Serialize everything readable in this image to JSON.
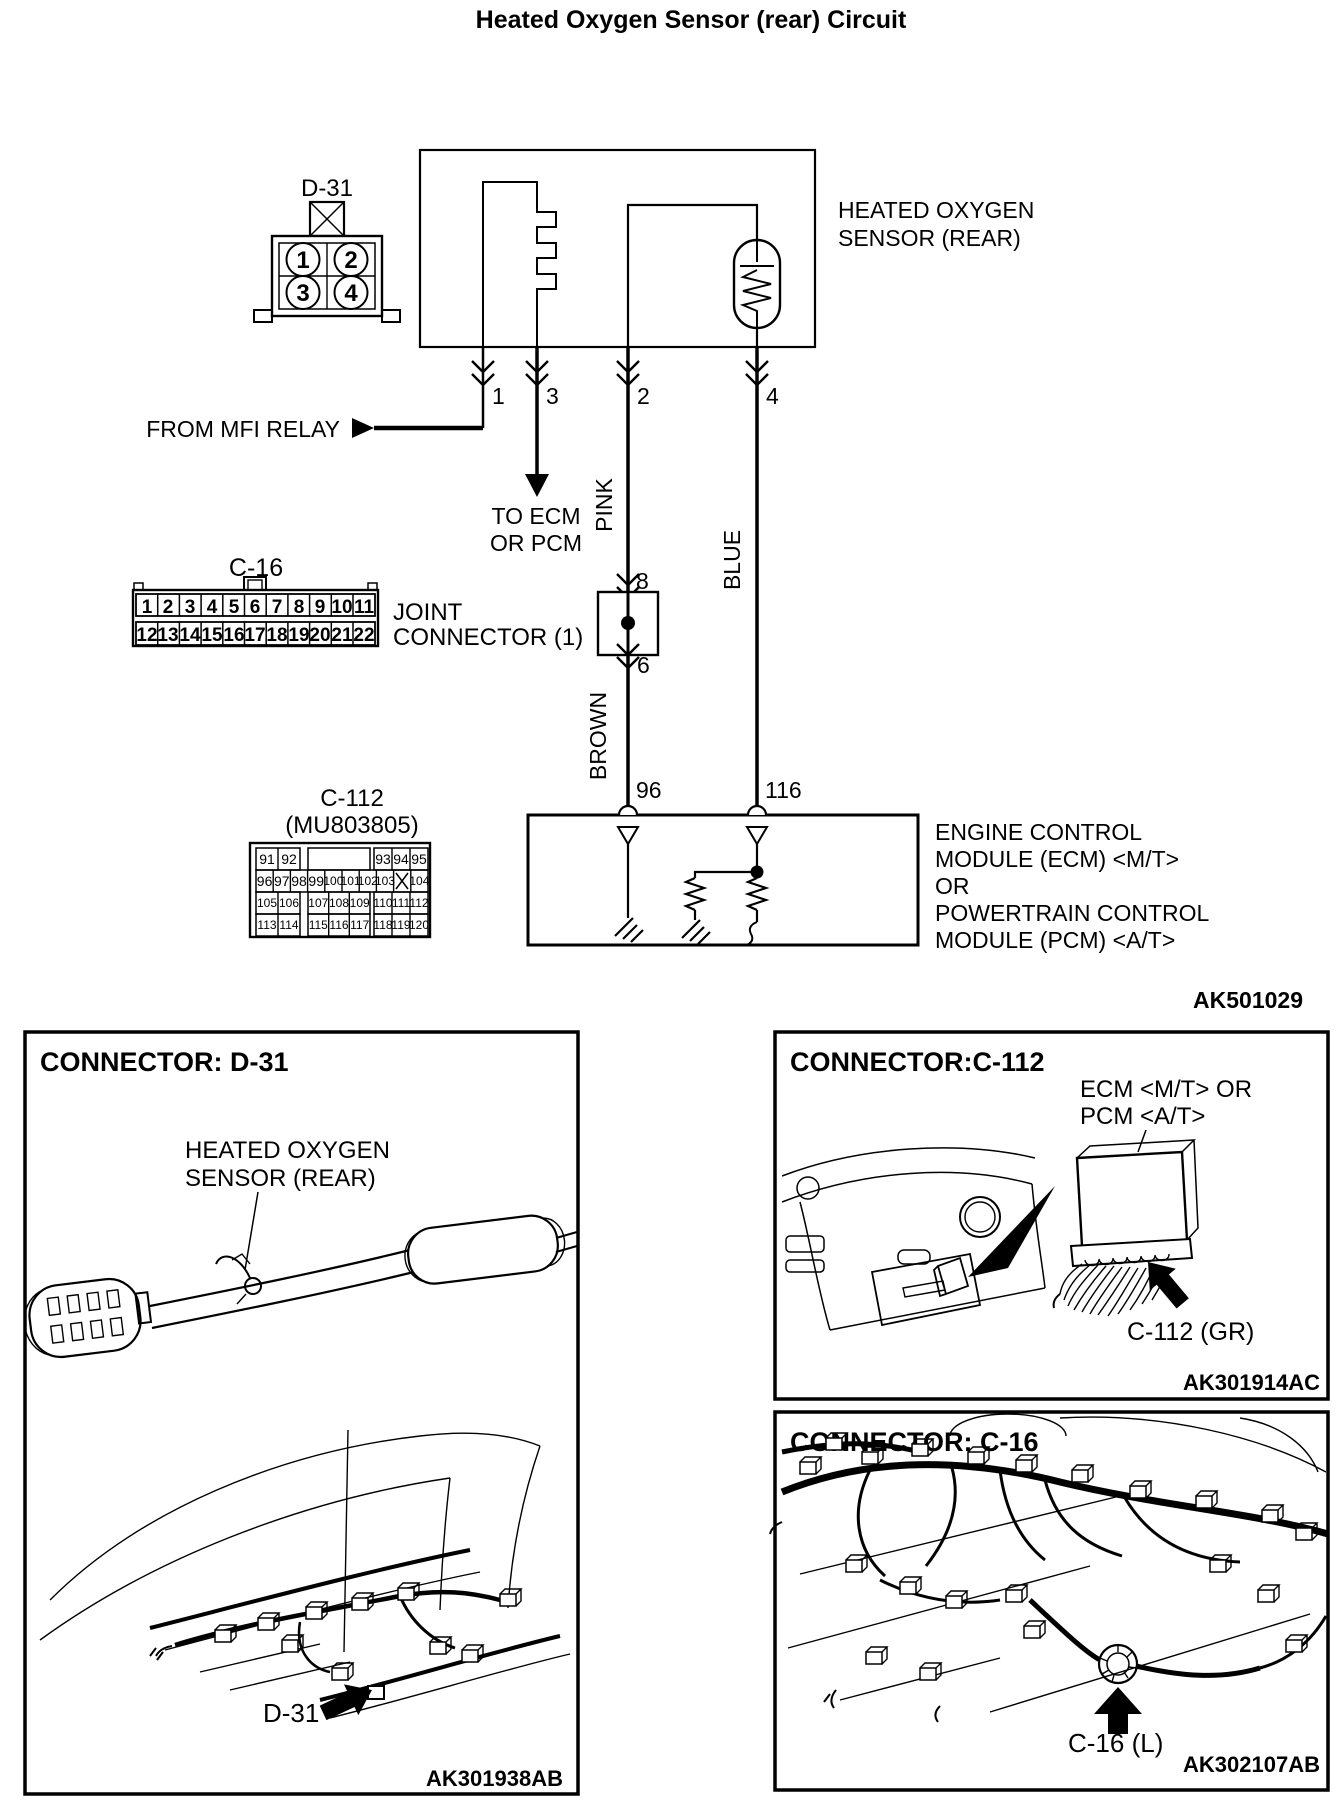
{
  "title": "Heated Oxygen Sensor (rear) Circuit",
  "diagram": {
    "d31": {
      "label": "D-31",
      "pin1": "1",
      "pin2": "2",
      "pin3": "3",
      "pin4": "4"
    },
    "sensor_label": {
      "line1": "HEATED OXYGEN",
      "line2": "SENSOR (REAR)"
    },
    "from_mfi_relay": "FROM MFI RELAY",
    "to_ecm": {
      "line1": "TO ECM",
      "line2": "OR PCM"
    },
    "pins": {
      "p1": "1",
      "p3": "3",
      "p2": "2",
      "p4": "4"
    },
    "wires": {
      "pink": "PINK",
      "blue": "BLUE",
      "brown": "BROWN"
    },
    "joint": {
      "line1": "JOINT",
      "line2": "CONNECTOR (1)",
      "pin_in": "8",
      "pin_out": "6"
    },
    "c16": {
      "label": "C-16",
      "row1": [
        "1",
        "2",
        "3",
        "4",
        "5",
        "6",
        "7",
        "8",
        "9",
        "10",
        "11"
      ],
      "row2": [
        "12",
        "13",
        "14",
        "15",
        "16",
        "17",
        "18",
        "19",
        "20",
        "21",
        "22"
      ]
    },
    "c112": {
      "label": "C-112",
      "part_no": "(MU803805)",
      "row1_left": [
        "91",
        "92"
      ],
      "row1_right": [
        "93",
        "94",
        "95"
      ],
      "row2": [
        "96",
        "97",
        "98",
        "99",
        "100",
        "101",
        "102",
        "103",
        "104"
      ],
      "x_cell": "X",
      "row3_left": [
        "105",
        "106"
      ],
      "row3_mid": [
        "107",
        "108",
        "109"
      ],
      "row3_right": [
        "110",
        "111",
        "112"
      ],
      "row4_left": [
        "113",
        "114"
      ],
      "row4_mid": [
        "115",
        "116",
        "117"
      ],
      "row4_right": [
        "118",
        "119",
        "120"
      ]
    },
    "ecm_pins": {
      "left": "96",
      "right": "116"
    },
    "ecm_label": [
      "ENGINE CONTROL",
      "MODULE (ECM) <M/T>",
      "OR",
      "POWERTRAIN CONTROL",
      "MODULE (PCM) <A/T>"
    ],
    "figure_code": "AK501029"
  },
  "panels": {
    "d31": {
      "header": "CONNECTOR: D-31",
      "label_line1": "HEATED OXYGEN",
      "label_line2": "SENSOR (REAR)",
      "callout": "D-31",
      "figure_code": "AK301938AB"
    },
    "c112": {
      "header": "CONNECTOR:C-112",
      "label_line1": "ECM <M/T> OR",
      "label_line2": "PCM <A/T>",
      "callout": "C-112 (GR)",
      "figure_code": "AK301914AC"
    },
    "c16": {
      "header": "CONNECTOR: C-16",
      "callout": "C-16 (L)",
      "figure_code": "AK302107AB"
    }
  }
}
